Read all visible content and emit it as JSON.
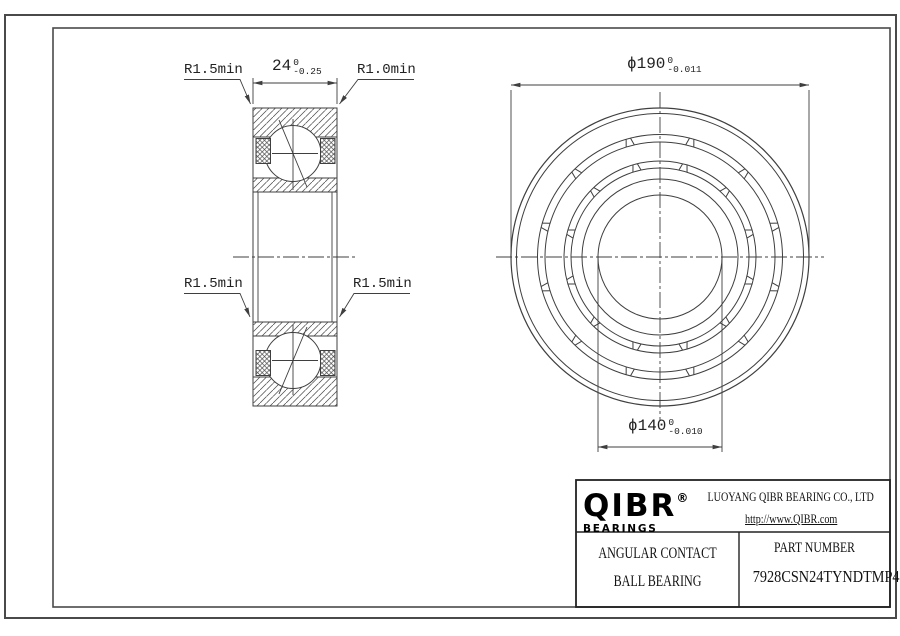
{
  "colors": {
    "line": "#3f3f3f",
    "frame": "#4a4a4a",
    "text": "#1f1f1f",
    "background": "#ffffff"
  },
  "dimensions": {
    "width": {
      "text": "24",
      "tol_upper": "0",
      "tol_lower": "-0.25"
    },
    "outer_diameter": {
      "text": "ϕ190",
      "tol_upper": "0",
      "tol_lower": "-0.011"
    },
    "bore_diameter": {
      "text": "ϕ140",
      "tol_upper": "0",
      "tol_lower": "-0.010"
    }
  },
  "radius_labels": {
    "top_left": "R1.5min",
    "top_right": "R1.0min",
    "mid_left": "R1.5min",
    "mid_right": "R1.5min"
  },
  "title_block": {
    "logo_text": "QIBR",
    "logo_reg": "®",
    "logo_sub": "BEARINGS",
    "company": "LUOYANG QIBR BEARING CO., LTD",
    "website": "http://www.QIBR.com",
    "product_line1": "ANGULAR CONTACT",
    "product_line2": "BALL BEARING",
    "part_label": "PART NUMBER",
    "part_number": "7928CSN24TYNDTMP4"
  }
}
